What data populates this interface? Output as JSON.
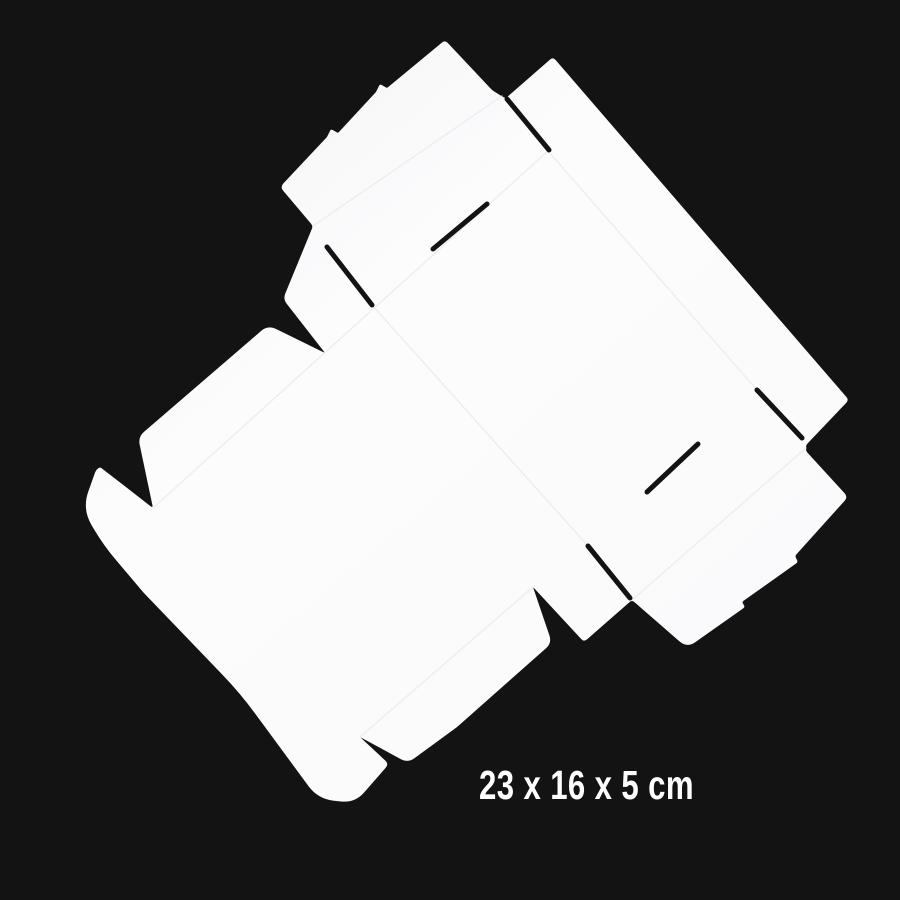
{
  "scene": {
    "description": "Flat-lay product photo of an unfolded white cardboard box die-cut blank, rotated diagonally on a black background",
    "background_color": "#131313"
  },
  "box_blank": {
    "name": "white-box-dieline",
    "paper_color": "#fcfcfd",
    "paper_shade_color": "#f3f3f5",
    "fold_line_color": "#ebebec",
    "cut_color": "#131313"
  },
  "dimensions_label": {
    "text": "23 x 16 x 5 cm",
    "color": "#ffffff"
  }
}
